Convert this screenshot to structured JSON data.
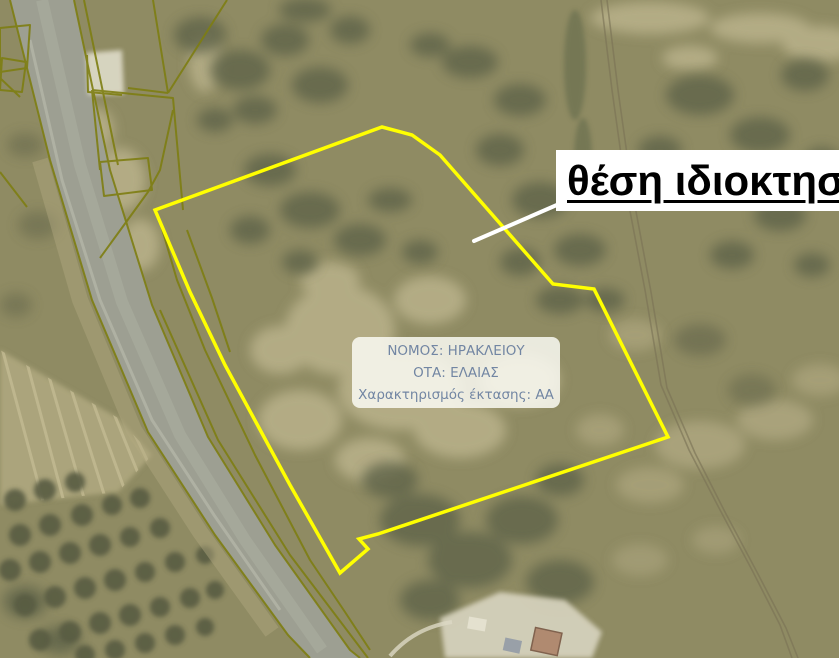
{
  "map": {
    "callout_label": "θέση ιδιοκτησ",
    "info_box": {
      "lines": [
        "ΝΟΜΟΣ: ΗΡΑΚΛΕΙΟΥ",
        "ΟΤΑ: ΕΛΑΙΑΣ",
        "Χαρακτηρισμός έκτασης: ΑΑ"
      ]
    },
    "colors": {
      "property_boundary": "#ffff00",
      "cadastral_lines": "#7e7e12",
      "callout_text": "#000000",
      "info_text": "#7286a3",
      "leader_line": "#ffffff"
    }
  }
}
